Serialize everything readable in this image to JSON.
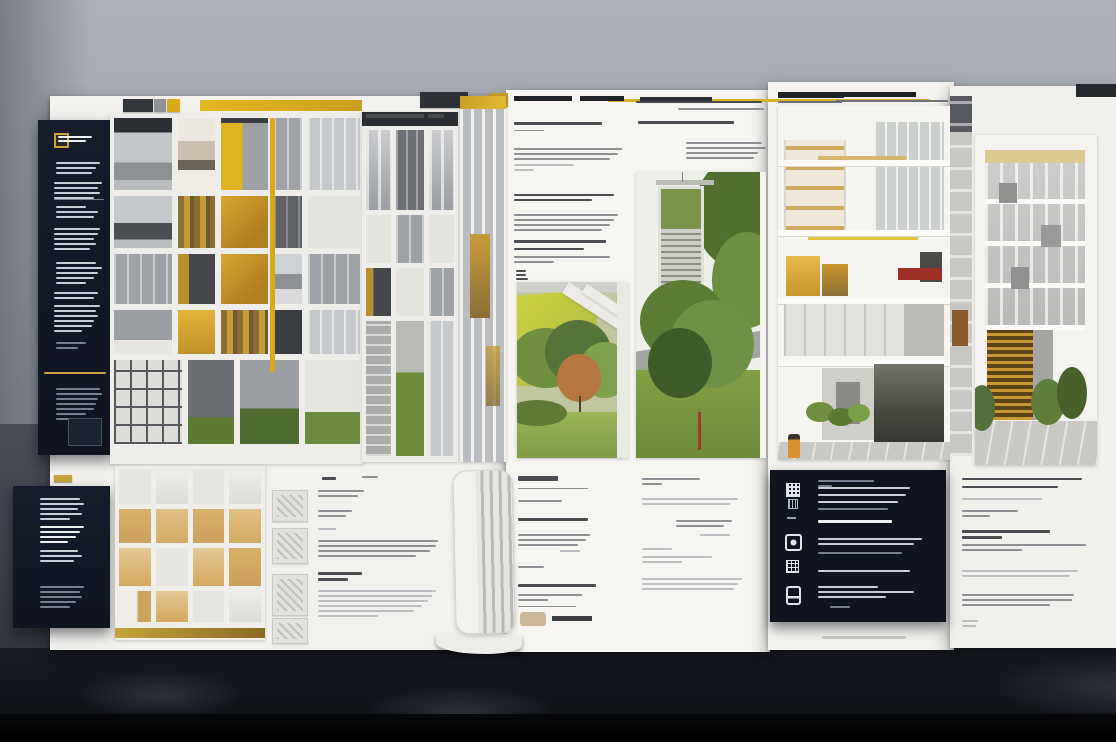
{
  "scene": {
    "label": "Photograph of architectural competition presentation boards standing on a dark table against a grey wall; dark navy info panels with gold accents on the left, yellow-accented modular facade photographs, tree and courtyard photos, a sectional cutaway model and building elevations; all small annotation text is illegible (greeked)."
  },
  "colors": {
    "wall_top": "#abb0b7",
    "wall_bottom": "#7f858e",
    "table": "#14171d",
    "black": "#000000",
    "board_white": "#f2f1ee",
    "navy": "#131927",
    "accent_gold": "#c9a23a",
    "accent_yellow": "#dfb31f",
    "amber": "#c79b3a",
    "tree_green": "#6f8f47",
    "grass_green": "#7e9a46",
    "autumn_orange": "#b5763f",
    "wall_yellow_green": "#c4ca42",
    "brick_red": "#9e3026",
    "wood_tan": "#d6b26a"
  },
  "icons": [
    "brand-logo-mark",
    "qr-code-icon",
    "chip-icon",
    "camera-icon",
    "grid-icon",
    "document-icon"
  ],
  "greek_palette": {
    "w": "#c9cdd6",
    "wd": "#eef0f4",
    "dim": "#76808f",
    "gold": "#c9a23a",
    "d": "#4a4c4f",
    "m": "#8d8f93",
    "l": "#bcbec1"
  },
  "facades": {
    "main_upper": [
      [
        "bal",
        "cream",
        "ya",
        "mg",
        "lg"
      ],
      [
        "bal2",
        "amd",
        "am",
        "dg",
        "wh"
      ],
      [
        "mg",
        "amL",
        "am",
        "whg",
        "mg"
      ],
      [
        "mgw",
        "am2",
        "amd",
        "dk",
        "lg"
      ]
    ],
    "main_ground": [
      [
        "int",
        "pl",
        "grn",
        "hedge"
      ]
    ],
    "secondary": [
      [
        "mgv",
        "dgv",
        "mgv"
      ],
      [
        "wh",
        "mg",
        "wh"
      ],
      [
        "amL",
        "wh",
        "mg"
      ],
      [
        "int2",
        "grass",
        "lg"
      ]
    ],
    "house_model": [
      [
        "hw",
        "hw2",
        "hw",
        "hw2"
      ],
      [
        "ht1",
        "ht2",
        "ht1",
        "ht2"
      ],
      [
        "ht3",
        "hw",
        "ht3",
        "ht1"
      ],
      [
        "htw",
        "ht3",
        "hw",
        "hw2"
      ]
    ]
  },
  "greek": {
    "navy_top": [
      {
        "x": 20,
        "y": 16,
        "bars": [
          34,
          28
        ],
        "c": "wd",
        "bh": 2,
        "gap": 2
      },
      {
        "x": 18,
        "y": 42,
        "bars": [
          44,
          40,
          36
        ],
        "c": "w"
      },
      {
        "x": 16,
        "y": 62,
        "bars": [
          48,
          44,
          46,
          40
        ],
        "c": "w"
      },
      {
        "x": 16,
        "y": 79,
        "bars": [
          50
        ],
        "c": "dim",
        "bh": 1
      },
      {
        "x": 18,
        "y": 86,
        "bars": [
          30,
          42,
          38
        ],
        "c": "w"
      },
      {
        "x": 16,
        "y": 108,
        "bars": [
          46,
          44,
          40,
          42,
          36
        ],
        "c": "w"
      },
      {
        "x": 18,
        "y": 142,
        "bars": [
          40,
          46,
          42,
          38,
          30
        ],
        "c": "w"
      },
      {
        "x": 16,
        "y": 172,
        "bars": [
          44,
          40
        ],
        "c": "w"
      },
      {
        "x": 16,
        "y": 185,
        "bars": [
          46,
          42,
          44,
          40,
          38,
          28
        ],
        "c": "w"
      },
      {
        "x": 18,
        "y": 222,
        "bars": [
          30,
          22
        ],
        "c": "dim"
      },
      {
        "x": 6,
        "y": 252,
        "bars": [
          62
        ],
        "c": "gold",
        "bh": 2
      },
      {
        "x": 18,
        "y": 268,
        "bars": [
          44,
          46,
          42,
          40,
          38,
          30,
          20
        ],
        "c": "dim"
      }
    ],
    "navy_bottom": [
      {
        "x": 27,
        "y": 12,
        "bars": [
          40,
          44,
          38,
          42,
          30
        ],
        "c": "w"
      },
      {
        "x": 27,
        "y": 40,
        "bars": [
          44,
          40,
          36,
          28
        ],
        "c": "wd",
        "bh": 2
      },
      {
        "x": 27,
        "y": 64,
        "bars": [
          38,
          42,
          34
        ],
        "c": "w"
      },
      {
        "x": 27,
        "y": 100,
        "bars": [
          44,
          40,
          42,
          36,
          30
        ],
        "c": "dim"
      }
    ],
    "main_text": [
      {
        "x": 6,
        "y": 7,
        "bars": [
          14
        ],
        "c": "d",
        "bh": 3,
        "gap": 2
      },
      {
        "x": 46,
        "y": 6,
        "bars": [
          16
        ],
        "c": "m",
        "bh": 2
      },
      {
        "x": 2,
        "y": 20,
        "bars": [
          46,
          40
        ],
        "c": "m"
      },
      {
        "x": 2,
        "y": 40,
        "bars": [
          34,
          28
        ],
        "c": "m"
      },
      {
        "x": 2,
        "y": 58,
        "bars": [
          18
        ],
        "c": "l"
      },
      {
        "x": 2,
        "y": 70,
        "bars": [
          120,
          118,
          112,
          98
        ],
        "c": "m"
      },
      {
        "x": 2,
        "y": 102,
        "bars": [
          44,
          30
        ],
        "c": "d",
        "bh": 3
      },
      {
        "x": 2,
        "y": 120,
        "bars": [
          118,
          114,
          110,
          104,
          96,
          60
        ],
        "c": "l"
      }
    ],
    "facade2_label": [
      {
        "x": 4,
        "y": 2,
        "bars": [
          58
        ],
        "c": "d",
        "bh": 4,
        "gap": 2
      },
      {
        "x": 66,
        "y": 2,
        "bars": [
          16
        ],
        "c": "d",
        "bh": 4
      }
    ],
    "center_left": [
      {
        "x": 2,
        "y": 30,
        "bars": [
          88
        ],
        "c": "d",
        "bh": 3
      },
      {
        "x": 2,
        "y": 38,
        "bars": [
          30
        ],
        "c": "m",
        "bh": 1
      },
      {
        "x": 2,
        "y": 56,
        "bars": [
          108,
          104,
          96
        ],
        "c": "m"
      },
      {
        "x": 2,
        "y": 72,
        "bars": [
          60,
          20
        ],
        "c": "l"
      },
      {
        "x": 2,
        "y": 102,
        "bars": [
          100,
          78
        ],
        "c": "d",
        "bh": 2
      },
      {
        "x": 2,
        "y": 122,
        "bars": [
          104,
          100,
          96,
          88
        ],
        "c": "m"
      },
      {
        "x": 2,
        "y": 148,
        "bars": [
          92
        ],
        "c": "d",
        "bh": 3
      },
      {
        "x": 2,
        "y": 156,
        "bars": [
          70
        ],
        "c": "d",
        "bh": 2
      },
      {
        "x": 2,
        "y": 164,
        "bars": [
          96,
          40
        ],
        "c": "m"
      },
      {
        "x": 4,
        "y": 178,
        "bars": [
          10,
          10,
          12
        ],
        "c": "d",
        "bh": 2,
        "gap": 2
      }
    ],
    "center_right": [
      {
        "x": 2,
        "y": 9,
        "bars": [
          126
        ],
        "c": "d",
        "bh": 2
      },
      {
        "x": 44,
        "y": 16,
        "bars": [
          86
        ],
        "c": "m",
        "bh": 2
      },
      {
        "x": 4,
        "y": 29,
        "bars": [
          96
        ],
        "c": "d",
        "bh": 3
      },
      {
        "x": 52,
        "y": 50,
        "bars": [
          76,
          80,
          72,
          68
        ],
        "c": "m"
      }
    ],
    "bottom_center_left": [
      {
        "x": 3,
        "y": 6,
        "bars": [
          40
        ],
        "c": "d",
        "bh": 5,
        "gap": 2
      },
      {
        "x": 3,
        "y": 18,
        "bars": [
          70
        ],
        "c": "m",
        "bh": 1
      },
      {
        "x": 3,
        "y": 30,
        "bars": [
          44
        ],
        "c": "m"
      },
      {
        "x": 3,
        "y": 48,
        "bars": [
          70
        ],
        "c": "d",
        "bh": 3
      },
      {
        "x": 3,
        "y": 64,
        "bars": [
          72,
          68,
          60
        ],
        "c": "m"
      },
      {
        "x": 45,
        "y": 80,
        "bars": [
          20
        ],
        "c": "l"
      },
      {
        "x": 3,
        "y": 96,
        "bars": [
          26
        ],
        "c": "m"
      },
      {
        "x": 3,
        "y": 114,
        "bars": [
          78
        ],
        "c": "d",
        "bh": 3
      },
      {
        "x": 3,
        "y": 124,
        "bars": [
          64,
          30
        ],
        "c": "m"
      },
      {
        "x": 3,
        "y": 136,
        "bars": [
          58
        ],
        "c": "m",
        "bh": 1
      }
    ],
    "bottom_center_right": [
      {
        "x": 2,
        "y": 8,
        "bars": [
          58,
          20
        ],
        "c": "m"
      },
      {
        "x": 2,
        "y": 28,
        "bars": [
          96,
          88
        ],
        "c": "l"
      },
      {
        "x": 36,
        "y": 50,
        "bars": [
          56,
          48
        ],
        "c": "m"
      },
      {
        "x": 60,
        "y": 64,
        "bars": [
          30
        ],
        "c": "l"
      },
      {
        "x": 2,
        "y": 78,
        "bars": [
          30
        ],
        "c": "l"
      },
      {
        "x": 2,
        "y": 86,
        "bars": [
          70,
          40
        ],
        "c": "l"
      },
      {
        "x": 2,
        "y": 108,
        "bars": [
          100,
          96,
          92
        ],
        "c": "l"
      }
    ],
    "right_navy": [
      {
        "x": 48,
        "y": 10,
        "bars": [
          56,
          14
        ],
        "c": "dim"
      },
      {
        "x": 48,
        "y": 17,
        "bars": [
          92
        ],
        "c": "w"
      },
      {
        "x": 48,
        "y": 24,
        "bars": [
          88
        ],
        "c": "w"
      },
      {
        "x": 48,
        "y": 31,
        "bars": [
          80
        ],
        "c": "w"
      },
      {
        "x": 48,
        "y": 38,
        "bars": [
          70
        ],
        "c": "dim"
      },
      {
        "x": 48,
        "y": 50,
        "bars": [
          74
        ],
        "c": "wd",
        "bh": 3
      },
      {
        "x": 48,
        "y": 68,
        "bars": [
          104,
          96
        ],
        "c": "w"
      },
      {
        "x": 48,
        "y": 82,
        "bars": [
          84
        ],
        "c": "dim"
      },
      {
        "x": 48,
        "y": 100,
        "bars": [
          92
        ],
        "c": "w",
        "bh": 2
      },
      {
        "x": 48,
        "y": 116,
        "bars": [
          60,
          96,
          68
        ],
        "c": "w"
      },
      {
        "x": 60,
        "y": 136,
        "bars": [
          20
        ],
        "c": "dim"
      }
    ],
    "far_right_text": [
      {
        "x": 4,
        "y": 8,
        "bars": [
          120
        ],
        "c": "d",
        "bh": 2
      },
      {
        "x": 4,
        "y": 16,
        "bars": [
          96
        ],
        "c": "d",
        "bh": 2
      },
      {
        "x": 4,
        "y": 28,
        "bars": [
          80
        ],
        "c": "l"
      },
      {
        "x": 4,
        "y": 40,
        "bars": [
          56,
          28
        ],
        "c": "m"
      },
      {
        "x": 4,
        "y": 60,
        "bars": [
          88,
          40
        ],
        "c": "d",
        "bh": 3
      },
      {
        "x": 4,
        "y": 74,
        "bars": [
          124,
          60
        ],
        "c": "m"
      },
      {
        "x": 4,
        "y": 100,
        "bars": [
          116,
          108
        ],
        "c": "l"
      },
      {
        "x": 4,
        "y": 124,
        "bars": [
          112,
          110,
          88
        ],
        "c": "m"
      },
      {
        "x": 4,
        "y": 150,
        "bars": [
          16,
          14
        ],
        "c": "l"
      }
    ]
  }
}
